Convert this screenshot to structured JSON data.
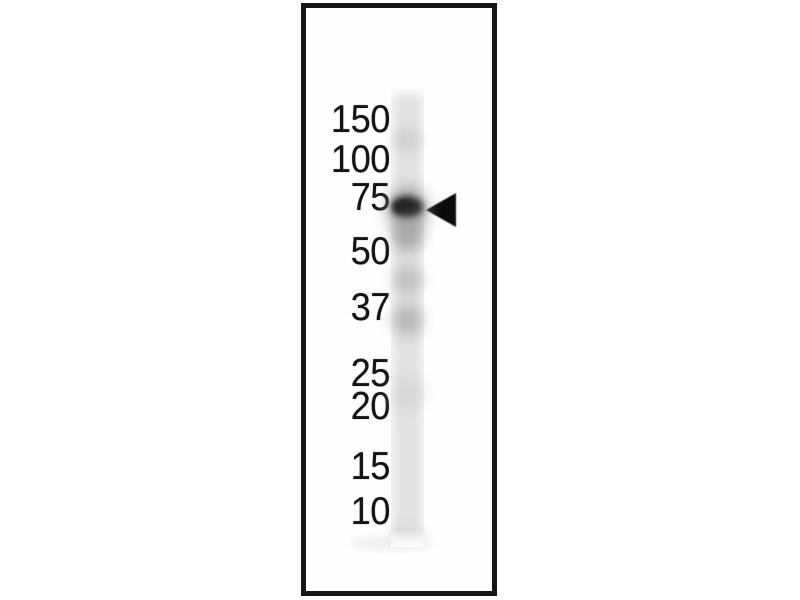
{
  "figure": {
    "background_color": "#ffffff"
  },
  "panel": {
    "background": "#fefefe",
    "border_color": "#161616"
  },
  "markers": {
    "text_color": "#141414",
    "labels": [
      "150",
      "100",
      "75",
      "50",
      "37",
      "25",
      "20",
      "15",
      "10"
    ]
  },
  "lane": {
    "base_color": "#e2e2e2",
    "edge_color": "#f1f1f1",
    "bands": [
      {
        "name": "faint-upper-smear",
        "top": 40,
        "height": 24,
        "left": 2,
        "width": 28,
        "color": "#c9c9c9",
        "blur": 6,
        "opacity": 0.7
      },
      {
        "name": "main-band-halo",
        "top": 100,
        "height": 44,
        "left": -3,
        "width": 39,
        "color": "#909090",
        "blur": 8,
        "opacity": 0.85
      },
      {
        "name": "main-band",
        "top": 108,
        "height": 22,
        "left": 0,
        "width": 32,
        "color": "#343434",
        "blur": 3.5,
        "opacity": 1
      },
      {
        "name": "main-band-core",
        "top": 112,
        "height": 13,
        "left": 3,
        "width": 22,
        "color": "#262626",
        "blur": 2.5,
        "opacity": 1
      },
      {
        "name": "sub-band-smear",
        "top": 132,
        "height": 32,
        "left": 2,
        "width": 29,
        "color": "#a3a3a3",
        "blur": 7,
        "opacity": 0.9
      },
      {
        "name": "mid-smear-upper",
        "top": 178,
        "height": 28,
        "left": 2,
        "width": 29,
        "color": "#bababa",
        "blur": 7,
        "opacity": 0.85
      },
      {
        "name": "mid-smear-37k",
        "top": 216,
        "height": 32,
        "left": 2,
        "width": 29,
        "color": "#b3b3b3",
        "blur": 7,
        "opacity": 0.9
      },
      {
        "name": "faint-low-smear",
        "top": 288,
        "height": 36,
        "left": 3,
        "width": 27,
        "color": "#d4d4d4",
        "blur": 8,
        "opacity": 0.85
      },
      {
        "name": "dye-front",
        "top": 436,
        "height": 16,
        "left": 0,
        "width": 33,
        "color": "#dbdbdb",
        "blur": 5,
        "opacity": 0.95
      }
    ],
    "bottom_smudge_color": "#eeeeee"
  },
  "arrow": {
    "color": "#0b0b0b"
  }
}
